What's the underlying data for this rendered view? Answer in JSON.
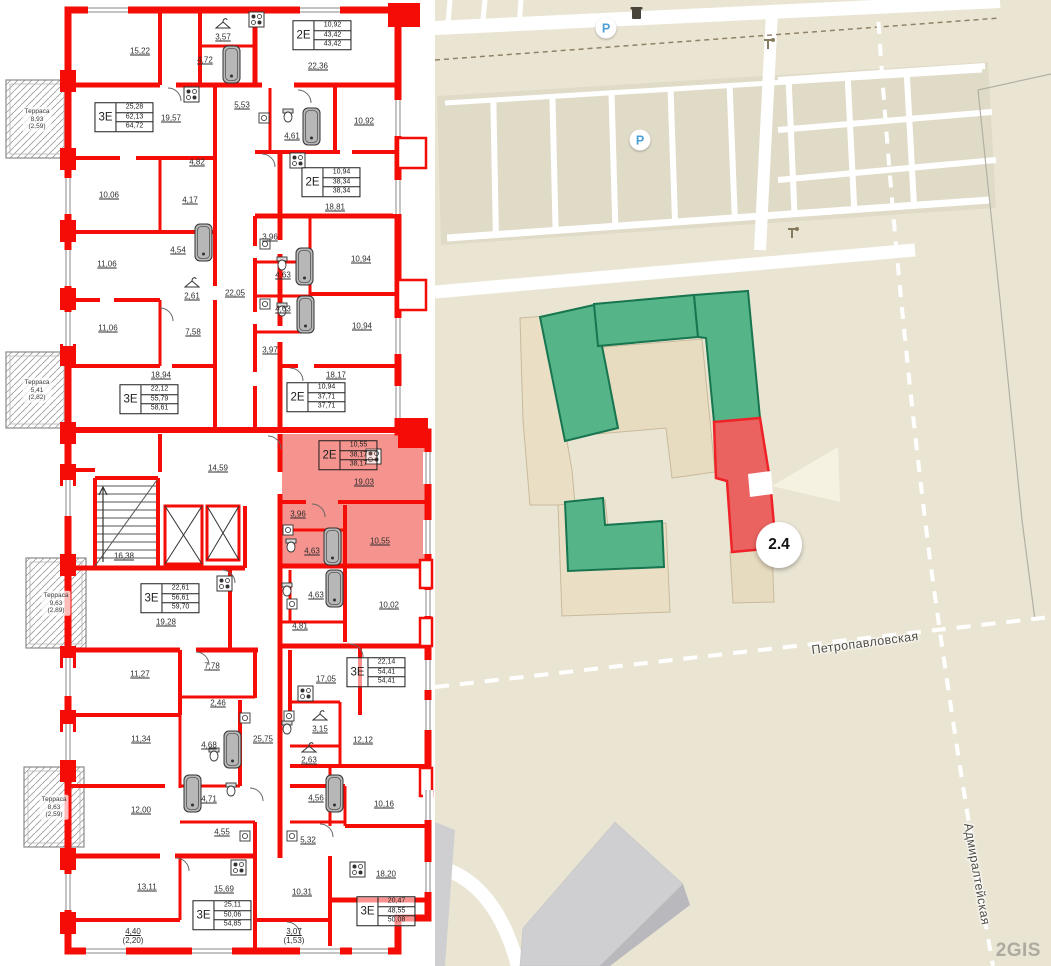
{
  "floor_plan": {
    "rooms": [
      {
        "label": "15,22",
        "x": 140,
        "y": 51
      },
      {
        "label": "3,57",
        "x": 223,
        "y": 37
      },
      {
        "label": "4,72",
        "x": 205,
        "y": 60
      },
      {
        "label": "22,36",
        "x": 318,
        "y": 66
      },
      {
        "label": "19,57",
        "x": 171,
        "y": 118
      },
      {
        "label": "5,53",
        "x": 242,
        "y": 105
      },
      {
        "label": "4,61",
        "x": 292,
        "y": 136
      },
      {
        "label": "10,92",
        "x": 364,
        "y": 121
      },
      {
        "label": "4,82",
        "x": 197,
        "y": 162
      },
      {
        "label": "10,06",
        "x": 109,
        "y": 195
      },
      {
        "label": "4,17",
        "x": 190,
        "y": 200
      },
      {
        "label": "18,81",
        "x": 335,
        "y": 207
      },
      {
        "label": "11,06",
        "x": 107,
        "y": 264
      },
      {
        "label": "4,54",
        "x": 178,
        "y": 250
      },
      {
        "label": "3,96",
        "x": 270,
        "y": 237
      },
      {
        "label": "10,94",
        "x": 361,
        "y": 259
      },
      {
        "label": "4,63",
        "x": 283,
        "y": 275
      },
      {
        "label": "2,61",
        "x": 192,
        "y": 296
      },
      {
        "label": "22,05",
        "x": 235,
        "y": 293
      },
      {
        "label": "11,06",
        "x": 108,
        "y": 328
      },
      {
        "label": "7,58",
        "x": 193,
        "y": 332
      },
      {
        "label": "4,63",
        "x": 283,
        "y": 309
      },
      {
        "label": "10,94",
        "x": 362,
        "y": 326
      },
      {
        "label": "3,97",
        "x": 270,
        "y": 350
      },
      {
        "label": "18,94",
        "x": 161,
        "y": 375
      },
      {
        "label": "18,17",
        "x": 336,
        "y": 375
      },
      {
        "label": "14,59",
        "x": 218,
        "y": 468
      },
      {
        "label": "16,38",
        "x": 124,
        "y": 556
      },
      {
        "label": "19,03",
        "x": 364,
        "y": 482
      },
      {
        "label": "3,96",
        "x": 298,
        "y": 514
      },
      {
        "label": "4,63",
        "x": 312,
        "y": 551
      },
      {
        "label": "10,55",
        "x": 380,
        "y": 541
      },
      {
        "label": "19,28",
        "x": 166,
        "y": 622
      },
      {
        "label": "4,63",
        "x": 316,
        "y": 595
      },
      {
        "label": "4,81",
        "x": 300,
        "y": 626
      },
      {
        "label": "10,02",
        "x": 389,
        "y": 605
      },
      {
        "label": "11,27",
        "x": 140,
        "y": 674
      },
      {
        "label": "7,78",
        "x": 212,
        "y": 666
      },
      {
        "label": "2,46",
        "x": 218,
        "y": 703
      },
      {
        "label": "17,05",
        "x": 326,
        "y": 679
      },
      {
        "label": "11,34",
        "x": 141,
        "y": 739
      },
      {
        "label": "4,68",
        "x": 209,
        "y": 745
      },
      {
        "label": "25,75",
        "x": 263,
        "y": 739
      },
      {
        "label": "3,15",
        "x": 320,
        "y": 729
      },
      {
        "label": "12,12",
        "x": 363,
        "y": 740
      },
      {
        "label": "2,63",
        "x": 309,
        "y": 760
      },
      {
        "label": "4,71",
        "x": 209,
        "y": 799
      },
      {
        "label": "4,56",
        "x": 316,
        "y": 798
      },
      {
        "label": "10,16",
        "x": 384,
        "y": 804
      },
      {
        "label": "12,00",
        "x": 141,
        "y": 810
      },
      {
        "label": "4,55",
        "x": 222,
        "y": 832
      },
      {
        "label": "5,32",
        "x": 308,
        "y": 840
      },
      {
        "label": "13,11",
        "x": 147,
        "y": 887
      },
      {
        "label": "15,69",
        "x": 224,
        "y": 889
      },
      {
        "label": "10,31",
        "x": 302,
        "y": 892
      },
      {
        "label": "18,20",
        "x": 386,
        "y": 874
      },
      {
        "label": "4,40",
        "sub": "(2,20)",
        "x": 133,
        "y": 936
      },
      {
        "label": "3,07",
        "sub": "(1,53)",
        "x": 294,
        "y": 936
      }
    ],
    "apartments": [
      {
        "type": "2Е",
        "values": [
          "10,92",
          "43,42",
          "43,42"
        ],
        "x": 322,
        "y": 35,
        "highlighted": false
      },
      {
        "type": "3Е",
        "values": [
          "25,28",
          "62,13",
          "64,72"
        ],
        "x": 124,
        "y": 117,
        "highlighted": false
      },
      {
        "type": "2Е",
        "values": [
          "10,94",
          "38,34",
          "38,34"
        ],
        "x": 331,
        "y": 182,
        "highlighted": false
      },
      {
        "type": "3Е",
        "values": [
          "22,12",
          "55,79",
          "58,61"
        ],
        "x": 149,
        "y": 399,
        "highlighted": false
      },
      {
        "type": "2Е",
        "values": [
          "10,94",
          "37,71",
          "37,71"
        ],
        "x": 316,
        "y": 397,
        "highlighted": false
      },
      {
        "type": "2Е",
        "values": [
          "10,55",
          "38,17",
          "38,17"
        ],
        "x": 348,
        "y": 455,
        "highlighted": true
      },
      {
        "type": "3Е",
        "values": [
          "22,61",
          "56,61",
          "59,70"
        ],
        "x": 170,
        "y": 598,
        "highlighted": false
      },
      {
        "type": "3Е",
        "values": [
          "22,14",
          "54,41",
          "54,41"
        ],
        "x": 376,
        "y": 672,
        "highlighted": false
      },
      {
        "type": "3Е",
        "values": [
          "25,11",
          "50,06",
          "54,85"
        ],
        "x": 222,
        "y": 915,
        "highlighted": false
      },
      {
        "type": "3Е",
        "values": [
          "20,47",
          "48,55",
          "50,08"
        ],
        "x": 386,
        "y": 911,
        "highlighted": false
      }
    ],
    "terraces": [
      {
        "name": "Терраса",
        "area": "8,93",
        "coeff": "(2,59)",
        "x": 37,
        "y": 119
      },
      {
        "name": "Терраса",
        "area": "5,41",
        "coeff": "(2,82)",
        "x": 37,
        "y": 390
      },
      {
        "name": "Терраса",
        "area": "9,63",
        "coeff": "(2,89)",
        "x": 56,
        "y": 603
      },
      {
        "name": "Терраса",
        "area": "8,63",
        "coeff": "(2,59)",
        "x": 54,
        "y": 807
      }
    ]
  },
  "map": {
    "marker": {
      "label": "2.4",
      "x": 344,
      "y": 545
    },
    "streets": [
      {
        "name": "Петропавловская",
        "x": 430,
        "y": 643,
        "angle": -7.5
      },
      {
        "name": "Адмиралтейская",
        "x": 542,
        "y": 874,
        "angle": 80
      }
    ],
    "parking_letter": "P",
    "parking_icons": [
      {
        "x": 171,
        "y": 28
      },
      {
        "x": 205,
        "y": 140
      }
    ],
    "logo": "2GIS",
    "colors": {
      "highlighted_section": "#ea6360",
      "green_section": "#56b489",
      "plan_wall": "#f60c06",
      "plan_highlight_fill": "#f5938e",
      "building_beige": "#eadec4",
      "map_background": "#eae5d3"
    }
  }
}
